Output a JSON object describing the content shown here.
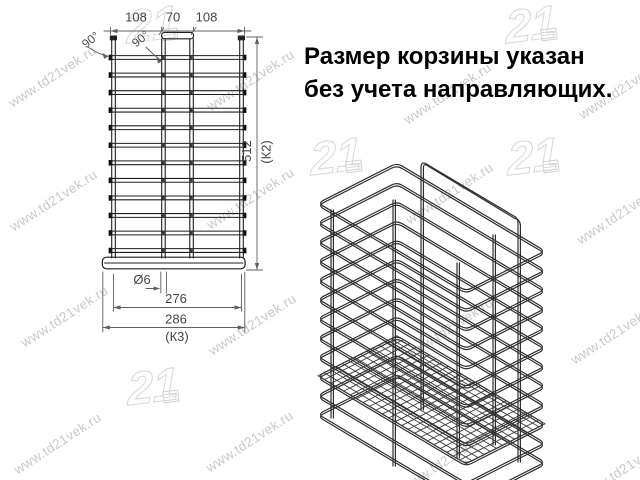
{
  "note": {
    "line1": "Размер корзины указан",
    "line2": "без учета направляющих."
  },
  "front_view": {
    "dim_top_left": "108",
    "dim_top_mid": "70",
    "dim_top_right": "108",
    "angle_left": "90°",
    "angle_mid": "90°",
    "dim_height": "512",
    "dim_height_code": "(К2)",
    "dim_wire_diameter": "Ø6",
    "dim_width_inner": "276",
    "dim_width_outer": "286",
    "dim_width_code": "(К3)",
    "wire_row_count": 12
  },
  "iso_view": {
    "hoop_count": 12
  },
  "watermark": {
    "text": "www.td21vek.ru",
    "logo_text": "21"
  },
  "colors": {
    "drawing_line": "#1f1f1f",
    "dimension_line": "#5f5f5f",
    "watermark_text": "#c9c9c9",
    "note_text": "#000000"
  }
}
